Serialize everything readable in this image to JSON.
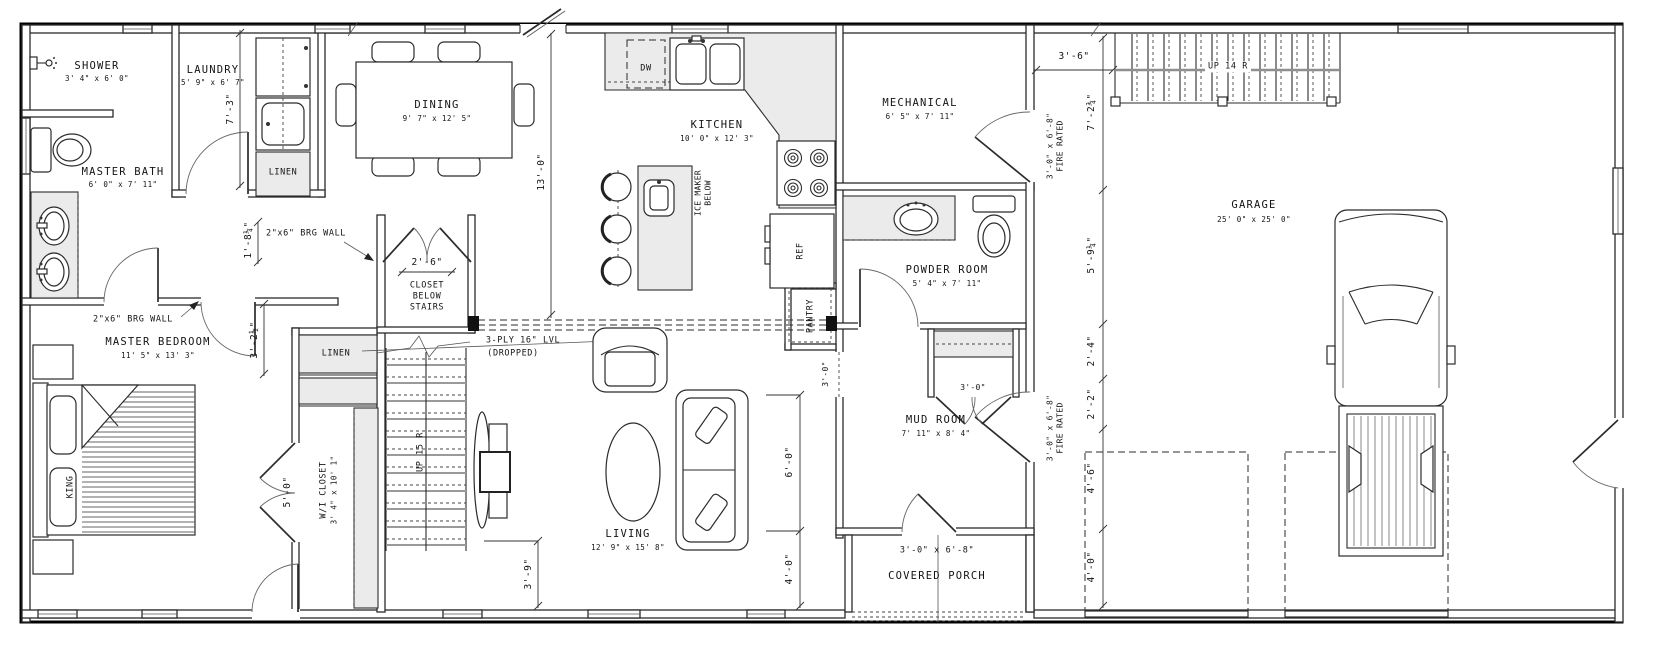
{
  "colors": {
    "background": "#ffffff",
    "line": "#2b2b2b",
    "light_fill": "#ebebeb"
  },
  "drawing": {
    "rooms": {
      "shower": {
        "name": "SHOWER",
        "dims": "3' 4\" x 6' 0\""
      },
      "laundry": {
        "name": "LAUNDRY",
        "dims": "5' 9\" x 6' 7\""
      },
      "master_bath": {
        "name": "MASTER BATH",
        "dims": "6' 0\" x 7' 11\""
      },
      "linen_laundry": {
        "name": "LINEN"
      },
      "linen_hall": {
        "name": "LINEN"
      },
      "dining": {
        "name": "DINING",
        "dims": "9' 7\" x 12' 5\""
      },
      "kitchen": {
        "name": "KITCHEN",
        "dims": "10' 0\" x 12' 3\""
      },
      "mechanical": {
        "name": "MECHANICAL",
        "dims": "6' 5\" x 7' 11\""
      },
      "powder": {
        "name": "POWDER ROOM",
        "dims": "5' 4\" x 7' 11\""
      },
      "garage": {
        "name": "GARAGE",
        "dims": "25' 0\" x 25' 0\""
      },
      "master_bedroom": {
        "name": "MASTER BEDROOM",
        "dims": "11' 5\" x 13' 3\""
      },
      "wi_closet": {
        "name": "W/I CLOSET",
        "dims": "3' 4\" x 10' 1\""
      },
      "closet_below_stairs": {
        "line1": "CLOSET",
        "line2": "BELOW",
        "line3": "STAIRS"
      },
      "mud": {
        "name": "MUD ROOM",
        "dims": "7' 11\" x 8' 4\""
      },
      "living": {
        "name": "LIVING",
        "dims": "12' 9\" x 15' 8\""
      },
      "porch": {
        "name": "COVERED PORCH"
      },
      "pantry": {
        "name": "PANTRY"
      }
    },
    "fixtures": {
      "dishwasher": "DW",
      "fridge": "REF",
      "ice_maker_line1": "ICE MAKER",
      "ice_maker_line2": "BELOW",
      "bed": "KING"
    },
    "stairs": {
      "main": "UP 15 R",
      "garage": "UP 14 R"
    },
    "notes": {
      "brg_wall_left": "2\"x6\" BRG WALL",
      "brg_wall_mid": "2\"x6\" BRG WALL",
      "lvl_line1": "3-PLY 16\" LVL",
      "lvl_line2": "(DROPPED)",
      "fire_door_mech_size": "3'-0\" x 6'-8\"",
      "fire_door_mech_rating": "FIRE RATED",
      "fire_door_mud_size": "3'-0\" x 6'-8\"",
      "fire_door_mud_rating": "FIRE RATED",
      "porch_door": "3'-0\" x 6'-8\"",
      "mud_closet_door": "3'-0\"",
      "living_mud_opening": "3'-0\""
    },
    "dimensions": {
      "laundry_depth": "7'-3\"",
      "hall_width": "1'-8¼\"",
      "bedroom_hall": "3'-2½\"",
      "closet_width": "2'-6\"",
      "kitchen_dining": "13'-0\"",
      "wi_closet_door": "5'-0\"",
      "stair_offset": "3'-9\"",
      "living_right_upper": "6'-0\"",
      "living_right_lower": "4'-0\"",
      "garage_top": "3'-6\"",
      "chain_1": "7'-2¾\"",
      "chain_2": "5'-9¼\"",
      "chain_3": "2'-4\"",
      "chain_4": "2'-2\"",
      "chain_5": "4'-6\"",
      "chain_6": "4'-0\""
    }
  }
}
